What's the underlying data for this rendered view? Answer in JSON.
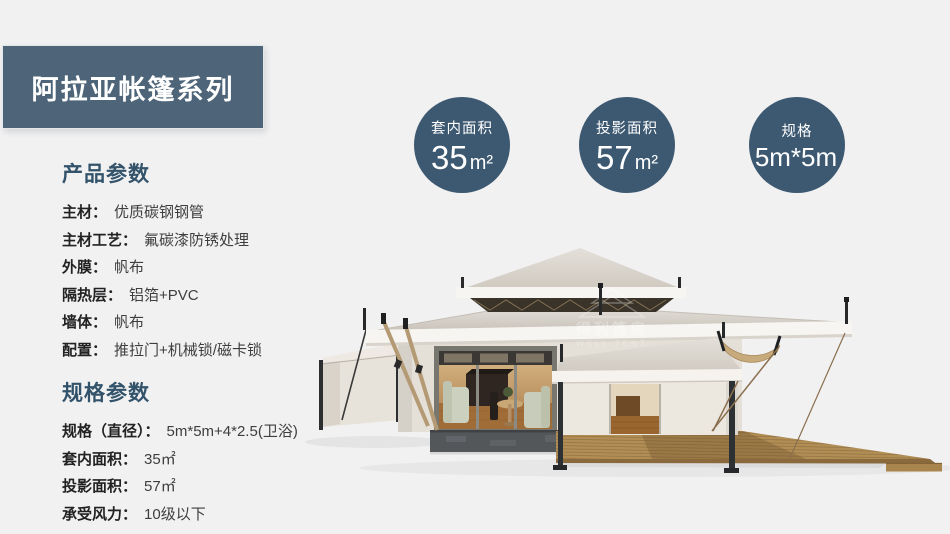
{
  "banner": {
    "title": "阿拉亚帐篷系列",
    "bg_color": "#4d6479",
    "text_color": "#ffffff"
  },
  "badges": [
    {
      "label": "套内面积",
      "value": "35",
      "unit": "m²"
    },
    {
      "label": "投影面积",
      "value": "57",
      "unit": "m²"
    },
    {
      "label": "规格",
      "value": "5m*5m",
      "unit": ""
    }
  ],
  "sections": [
    {
      "title": "产品参数",
      "rows": [
        {
          "label": "主材：",
          "value": "优质碳钢钢管"
        },
        {
          "label": "主材工艺：",
          "value": "氟碳漆防锈处理"
        },
        {
          "label": "外膜：",
          "value": "帆布"
        },
        {
          "label": "隔热层：",
          "value": "铝箔+PVC"
        },
        {
          "label": "墙体：",
          "value": "帆布"
        },
        {
          "label": "配置：",
          "value": "推拉门+机械锁/磁卡锁"
        }
      ]
    },
    {
      "title": "规格参数",
      "rows": [
        {
          "label": "规格（直径）：",
          "value": "5m*5m+4*2.5(卫浴)"
        },
        {
          "label": "套内面积：",
          "value": "35㎡"
        },
        {
          "label": "投影面积：",
          "value": "57㎡"
        },
        {
          "label": "承受风力：",
          "value": "10级以下"
        }
      ]
    }
  ],
  "watermark": {
    "cn": "得利篷房",
    "en": "WELL TENT"
  },
  "illustration": {
    "description": "glamping pagoda tent with wooden deck"
  },
  "colors": {
    "page_background": "#f1f1f2",
    "banner": "#4d6479",
    "badge": "#3d5971",
    "heading": "#33536b",
    "body_text": "#3e3e3e",
    "roof_canvas": "#d6d1c9",
    "deck_wood": "#b28e55",
    "stone_base": "#54575a"
  }
}
